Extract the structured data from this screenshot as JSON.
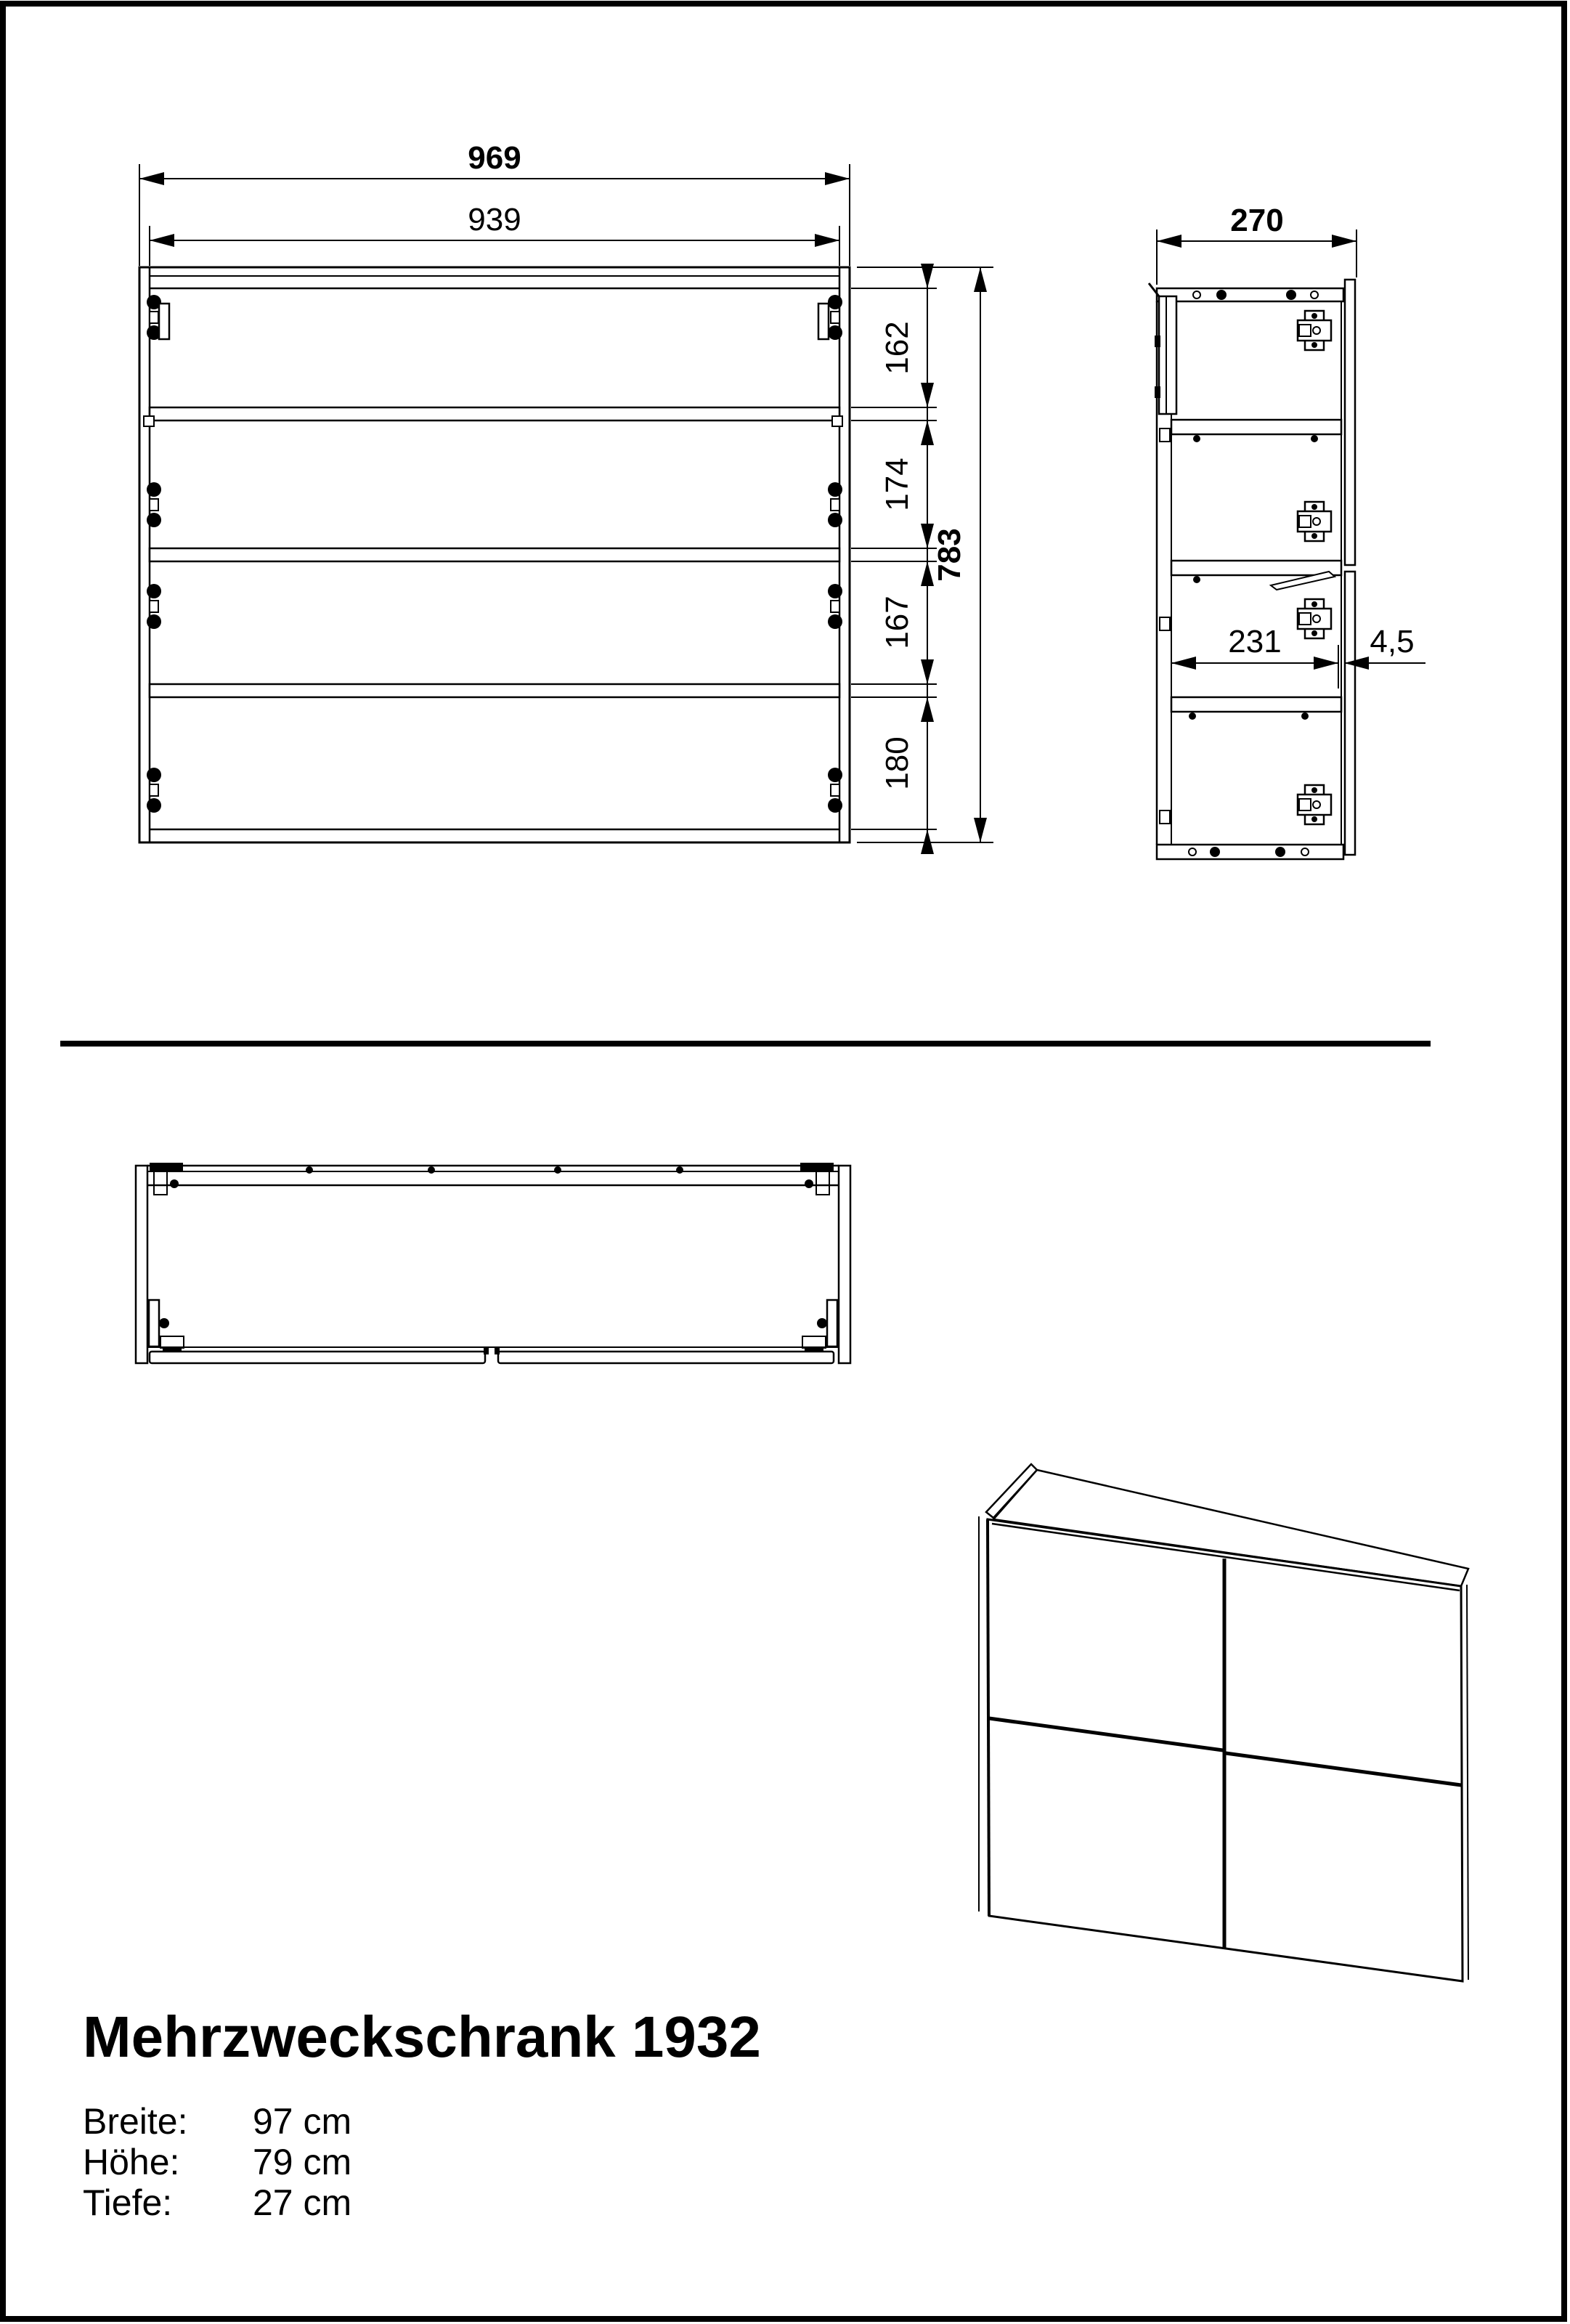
{
  "title": "Mehrzweckschrank 1932",
  "specs": [
    {
      "label": "Breite:",
      "value": "97 cm"
    },
    {
      "label": "Höhe:",
      "value": "79 cm"
    },
    {
      "label": "Tiefe:",
      "value": "27 cm"
    }
  ],
  "dimensions": {
    "front": {
      "outer_width": "969",
      "inner_width": "939",
      "section_heights": [
        "162",
        "174",
        "167",
        "180"
      ],
      "total_height": "783"
    },
    "side": {
      "depth": "270",
      "inner_depth": "231",
      "door_gap": "4,5"
    }
  },
  "colors": {
    "line": "#000000",
    "background": "#ffffff"
  }
}
